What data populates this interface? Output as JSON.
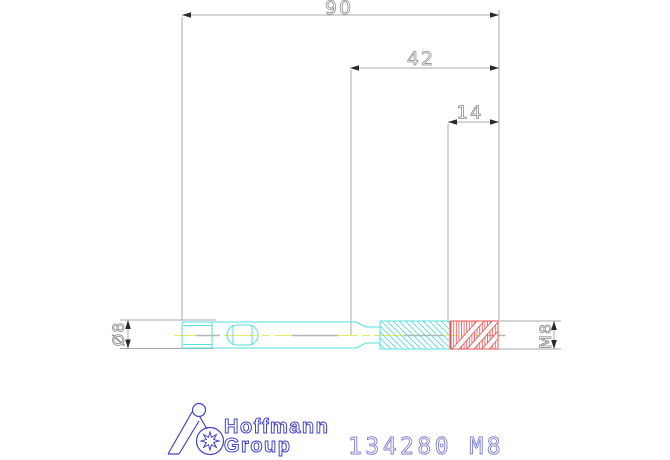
{
  "drawing": {
    "part_number": "134280 M8",
    "dimensions": {
      "overall_length": "90",
      "flute_length": "42",
      "thread_length": "14",
      "shank_diameter": "Ø8",
      "thread_designation": "M8"
    },
    "logo": {
      "line1": "Hoffmann",
      "line2": "Group"
    },
    "colors": {
      "tool_outline": "#57dede",
      "thread_zone": "#f05050",
      "centerline": "#e8e868",
      "centerline_dash": "#b5b5b5",
      "dimension_line": "#a8a8a8",
      "dimension_text": "#8f8f8f",
      "arrow": "#2a2a2a",
      "logo_blue": "#4343c8",
      "part_number_blue": "#7d7dd2"
    }
  }
}
